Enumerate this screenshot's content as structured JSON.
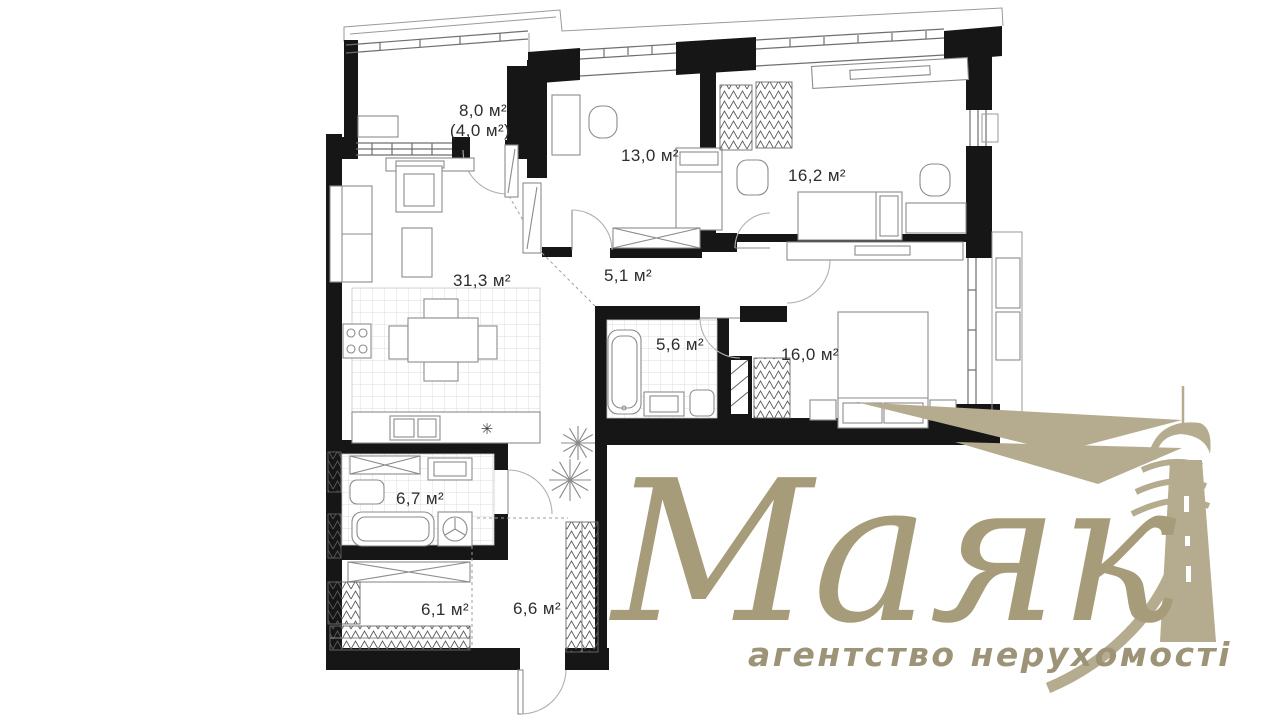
{
  "plan": {
    "rooms": [
      {
        "name": "terrace",
        "label": "8,0 м²",
        "label2": "(4,0 м²)"
      },
      {
        "name": "living-kitchen",
        "label": "31,3 м²"
      },
      {
        "name": "bedroom-1",
        "label": "13,0 м²"
      },
      {
        "name": "bedroom-2",
        "label": "16,2 м²"
      },
      {
        "name": "corridor",
        "label": "5,1 м²"
      },
      {
        "name": "bathroom-1",
        "label": "5,6 м²"
      },
      {
        "name": "bedroom-3",
        "label": "16,0 м²"
      },
      {
        "name": "bathroom-2",
        "label": "6,7 м²"
      },
      {
        "name": "wardrobe-room",
        "label": "6,1 м²"
      },
      {
        "name": "hallway",
        "label": "6,6 м²"
      }
    ],
    "symbols": {
      "fridge": "✳"
    }
  },
  "logo": {
    "brand": "Маяк",
    "tagline": "агентство нерухомості",
    "text_color": "#a79c7a",
    "mark_color": "#b5ab8f",
    "tagline_color": "#9d9377"
  },
  "colors": {
    "wall": "#161616",
    "furniture_line": "#8b8b8b",
    "tile_line": "#dcdcdc",
    "label": "#2e2e2e",
    "background": "#ffffff"
  }
}
